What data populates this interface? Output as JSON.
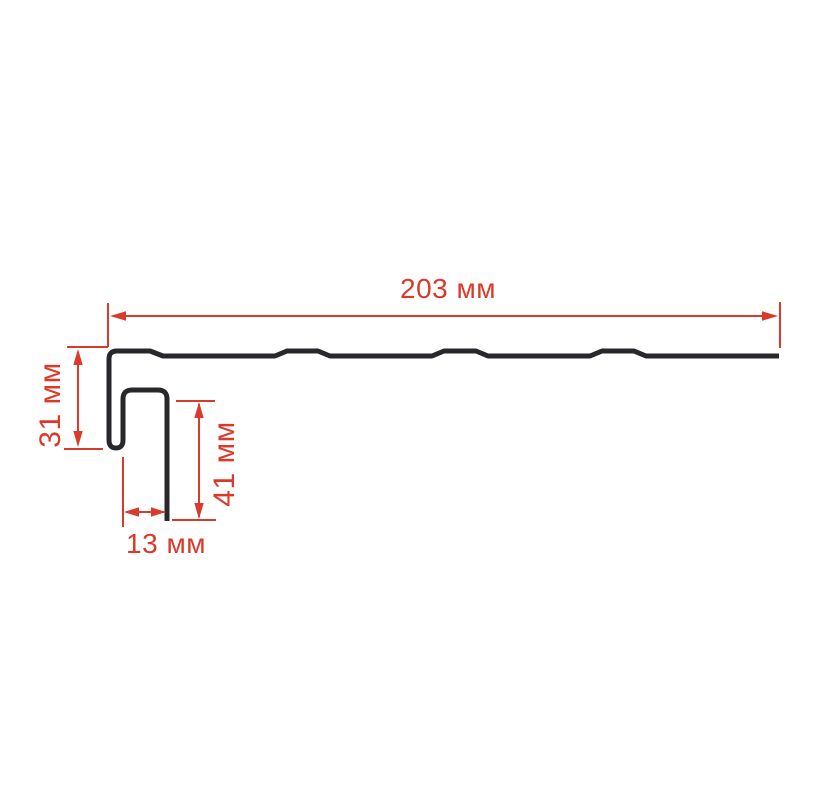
{
  "page": {
    "background_color": "#ffffff"
  },
  "diagram": {
    "type": "profile-cross-section-drawing",
    "profile_color": "#28282c",
    "dimension_color": "#d93a29",
    "unit": "мм",
    "dimensions": {
      "top_width": {
        "label": "203 мм",
        "value": 203,
        "orientation": "horizontal"
      },
      "left_height": {
        "label": "31 мм",
        "value": 31,
        "orientation": "vertical"
      },
      "inner_height": {
        "label": "41 мм",
        "value": 41,
        "orientation": "vertical"
      },
      "bottom_width": {
        "label": "13 мм",
        "value": 13,
        "orientation": "horizontal"
      }
    }
  }
}
